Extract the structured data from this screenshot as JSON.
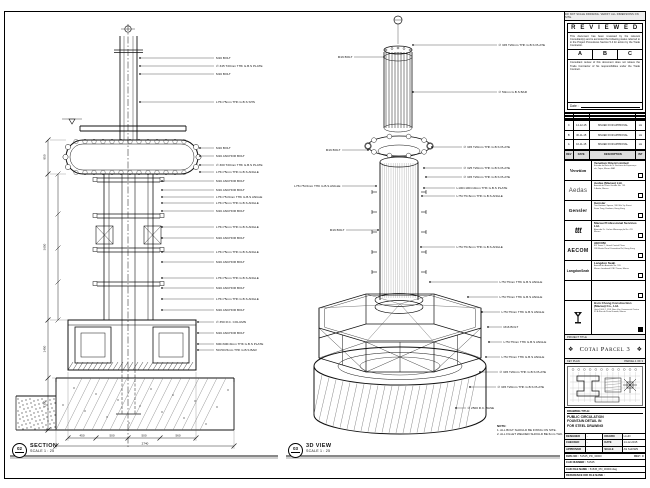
{
  "sheet": {
    "top_strip": "DO NOT SCALE DRAWING. VERIFY ALL DIMENSIONS ON SITE.",
    "accent_color": "#111111",
    "paper_color": "#ffffff"
  },
  "views": {
    "section": {
      "tag": "02",
      "title": "SECTION",
      "scale": "SCALE 1 : 25"
    },
    "view3d": {
      "tag": "03",
      "title": "3D VIEW",
      "scale": "SCALE 1 : 25"
    }
  },
  "notes": {
    "heading": "NOTE:",
    "line1": "1. ALL BOLT SHOULD BE FIXING ON SITE.",
    "line2": "2. ALL FILLET WELDED SHOULD BE 6mm THK."
  },
  "reviewed": {
    "title": "R E V I E W E D",
    "body1": "This document has been reviewed by the relevant Consultant(s) and is accorded the following status referred to in the Project Procedures Section 5.4 for action by the Trade Contractor.",
    "options": [
      "A",
      "B",
      "C"
    ],
    "body2": "Consultant review of this document does not relieve the Trade Contractor of his responsibilities under the Trade Contract.",
    "date_label": "Date :"
  },
  "revisions": {
    "header": [
      "REV",
      "DATE",
      "DESCRIPTION",
      "INT"
    ],
    "rows": [
      [
        "C",
        "14-12-15",
        "ISSUED FOR APPROVAL",
        "LH"
      ],
      [
        "B",
        "30-11-15",
        "ISSUED FOR APPROVAL",
        "LH"
      ],
      [
        "A",
        "16-11-15",
        "ISSUED FOR APPROVAL",
        "LH"
      ]
    ]
  },
  "consultants": [
    {
      "logo": "Venetian",
      "name": "Venetian Orient Limited",
      "addr1": "Estrada da Baía de N. Senhora da Esperança",
      "addr2": "s/n, Taipa, Macau SAR"
    },
    {
      "logo": "Aedas",
      "name": "Aedas (Macau) Ltd.",
      "addr1": "Avenida da Praia Grande No. 759",
      "addr2": "5 Andar, Macau"
    },
    {
      "logo": "Gensler",
      "name": "Gensler",
      "addr1": "Two Harbour Square, 180 Wai Yip Street",
      "addr2": "Kwun Tong, Kowloon, Hong Kong"
    },
    {
      "logo": "ttt",
      "name": "Macau Professional Services Ltd.",
      "addr1": "Alameda Dr. Carlos d'Assumpção No. 411",
      "addr2": "Macau"
    },
    {
      "logo": "AECOM",
      "name": "AECOM",
      "addr1": "8/F Tower 2, Grand Central Plaza",
      "addr2": "138 Shatin Rural Committee Rd, Hong Kong"
    },
    {
      "logo": "LangdonSeah",
      "name": "Langdon Seah",
      "addr1": "Avenida da Amizade No. 555",
      "addr2": "Macau Landmark ICBC Tower, Macau"
    },
    {
      "logo": "",
      "name": "",
      "addr1": "",
      "addr2": ""
    }
  ],
  "contractor": {
    "name": "Hsin Chong Construction (Macau) Co., Ltd.",
    "addr1": "Units 1904-7, 19/F, Nam Van Commercial Centre",
    "addr2": "57-A Rua da Praia Grande, Macau"
  },
  "project": {
    "label": "PROJECT TITLE",
    "name": "Cotai Parcel 3",
    "ornament": "❖"
  },
  "key_plan": {
    "label": "KEY PLAN",
    "right_label": "PARCEL 1 OF 3"
  },
  "drawing_title": {
    "label": "DRAWING TITLE:",
    "lines": [
      "PUBLIC CIRCULATION",
      "FOUNTAIN DETAIL IN",
      "FOR STEEL DRAWING"
    ]
  },
  "signoff": {
    "designed_label": "DESIGNED",
    "designed": "-",
    "drawn_label": "DRAWN",
    "drawn": "LLHO",
    "checked_label": "CHECKED",
    "checked": "-",
    "date_label": "DATE",
    "date": "14-12-2015",
    "approved_label": "APPROVED",
    "approved": "-",
    "scale_label": "SCALE",
    "scale": "AS SHOWN"
  },
  "dwg": {
    "dwg_label": "DWG NO :",
    "dwg_no": "51545_PD_30000",
    "rev_label": "REV :",
    "rev": "C",
    "cad_number_label": "CAD NUMBER :",
    "cad_number": "51545",
    "cad_file_label": "CAD FILE NAME :",
    "cad_file": "51545_PD_30000.dwg",
    "ref_label": "REFERENCE DIR FILE NAME :"
  },
  "section_callouts": [
    "M16 BOLT",
    "∅ 345 T20mm THK G.B.S PLATE",
    "M16 BOLT",
    "L75×75mm THK G.B.S SHS",
    "M16 BOLT",
    "M16 ANCHOR BOLT",
    "∅ 300 T20mm THK G.B.S PLATE",
    "L75×75mm THK G.B.S ANGLE",
    "M16 ANCHOR BOLT",
    "M16 ANCHOR BOLT",
    "L75×75×6mm THK G.B.S ANGLE",
    "L75×75mm THK G.B.S ANGLE",
    "M16 ANCHOR BOLT",
    "L75×75mm THK G.B.S ANGLE",
    "M16 ANCHOR BOLT",
    "L75×75mm THK G.B.S ANGLE",
    "M16 ANCHOR BOLT",
    "L75×75mm THK G.B.S ANGLE",
    "M16 ANCHOR BOLT",
    "L75×75mm THK G.B.S ANGLE",
    "M16 ANCHOR BOLT",
    "∅ 350 R.C. COLUMN",
    "M16 ANCHOR BOLT",
    "600×600×9mm THK G.B.S PLATE",
    "50×50×5mm THK G.B.S BAR"
  ],
  "view3d_callouts_right": [
    "∅ 345 T20mm THK G.B.S PLATE",
    "∅ 50mm G.B.S BAR",
    "∅ 345 T20mm THK G.B.S PLATE",
    "∅ 325 T20mm THK G.B.S PLATE",
    "∅ 345 T20mm THK G.B.S PLATE",
    "L100×100×10mm THK G.B.S PLATE",
    "L75×75×6mm THK G.B.S ANGLE",
    "L75×75×6mm THK G.B.S ANGLE",
    "L75×75mm THK G.B.S ANGLE",
    "L75×75mm THK G.B.S ANGLE",
    "L75×75mm THK G.B.S ANGLE",
    "M16 BOLT",
    "L75×75mm THK G.B.S ANGLE",
    "L75×75mm THK G.B.S ANGLE",
    "∅ 345 T20mm THK G.B.S PLATE",
    "∅ 345 T20mm THK G.B.S PLATE",
    "∅ 2500 R.C. BASE"
  ],
  "view3d_callouts_left": [
    "M16 BOLT",
    "M16 BOLT",
    "L75×75×6mm THK G.B.S ANGLE",
    "M16 BOLT"
  ],
  "dims": {
    "left": [
      "850",
      "3650",
      "1450",
      "1300"
    ],
    "bottom": [
      "450",
      "500",
      "500",
      "560"
    ],
    "overall": "2740"
  }
}
